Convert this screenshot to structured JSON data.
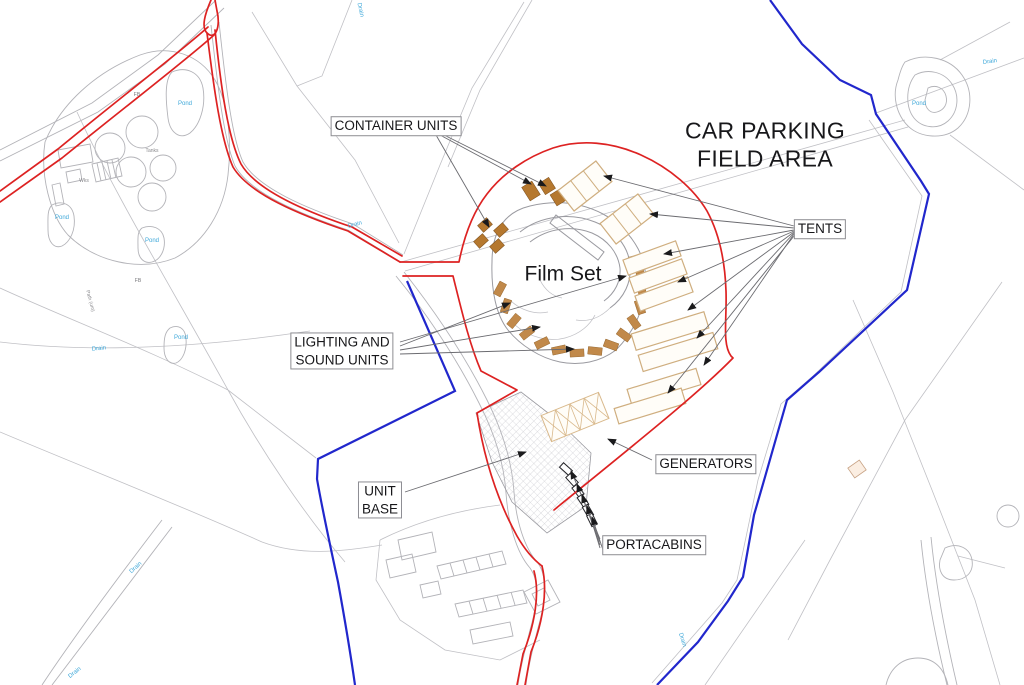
{
  "colors": {
    "site_red": "#dd2222",
    "boundary_blue": "#2127cc",
    "unit_brown": "#b5782f",
    "unit_brown_light": "#c1894a",
    "tent_tan": "#cfae7f",
    "generator_tan": "#d9b98c",
    "map_gray": "#b3b3b8",
    "water_blue": "#3ca7d9"
  },
  "labels": {
    "container_units": "CONTAINER UNITS",
    "car_parking": {
      "line1": "CAR PARKING",
      "line2": "FIELD AREA"
    },
    "tents": "TENTS",
    "film_set": "Film Set",
    "lighting_sound": {
      "line1": "LIGHTING AND",
      "line2": "SOUND UNITS"
    },
    "unit_base": {
      "line1": "UNIT",
      "line2": "BASE"
    },
    "generators": "GENERATORS",
    "portacabins": "PORTACABINS"
  },
  "map_labels": [
    {
      "text": "Pond",
      "x": 185,
      "y": 104,
      "color": "#3ca7d9",
      "size": 6,
      "rot": 0
    },
    {
      "text": "Pond",
      "x": 62,
      "y": 218,
      "color": "#3ca7d9",
      "size": 6,
      "rot": 0
    },
    {
      "text": "Pond",
      "x": 152,
      "y": 241,
      "color": "#3ca7d9",
      "size": 6,
      "rot": 0
    },
    {
      "text": "Pond",
      "x": 181,
      "y": 338,
      "color": "#3ca7d9",
      "size": 6,
      "rot": 0
    },
    {
      "text": "Pond",
      "x": 919,
      "y": 104,
      "color": "#3ca7d9",
      "size": 6,
      "rot": 0
    },
    {
      "text": "Drain",
      "x": 99,
      "y": 349,
      "color": "#3ca7d9",
      "size": 6,
      "rot": -6
    },
    {
      "text": "Drain",
      "x": 360,
      "y": 10,
      "color": "#3ca7d9",
      "size": 6,
      "rot": 78
    },
    {
      "text": "Drain",
      "x": 355,
      "y": 225,
      "color": "#3ca7d9",
      "size": 6,
      "rot": -15
    },
    {
      "text": "Drain",
      "x": 136,
      "y": 568,
      "color": "#3ca7d9",
      "size": 6,
      "rot": -42
    },
    {
      "text": "Drain",
      "x": 75,
      "y": 673,
      "color": "#3ca7d9",
      "size": 6,
      "rot": -38
    },
    {
      "text": "Drain",
      "x": 990,
      "y": 62,
      "color": "#3ca7d9",
      "size": 6,
      "rot": -8
    },
    {
      "text": "Drain",
      "x": 682,
      "y": 640,
      "color": "#3ca7d9",
      "size": 6,
      "rot": 72
    },
    {
      "text": "Tanks",
      "x": 152,
      "y": 151,
      "color": "#8a8a8e",
      "size": 5,
      "rot": 0
    },
    {
      "text": "Wks",
      "x": 84,
      "y": 181,
      "color": "#8a8a8e",
      "size": 5,
      "rot": 0
    },
    {
      "text": "FB",
      "x": 137,
      "y": 95,
      "color": "#77777b",
      "size": 5,
      "rot": 0
    },
    {
      "text": "FB",
      "x": 138,
      "y": 281,
      "color": "#77777b",
      "size": 5,
      "rot": 0
    },
    {
      "text": "Path (um)",
      "x": 90,
      "y": 301,
      "color": "#8a8a8e",
      "size": 5,
      "rot": 75
    }
  ]
}
